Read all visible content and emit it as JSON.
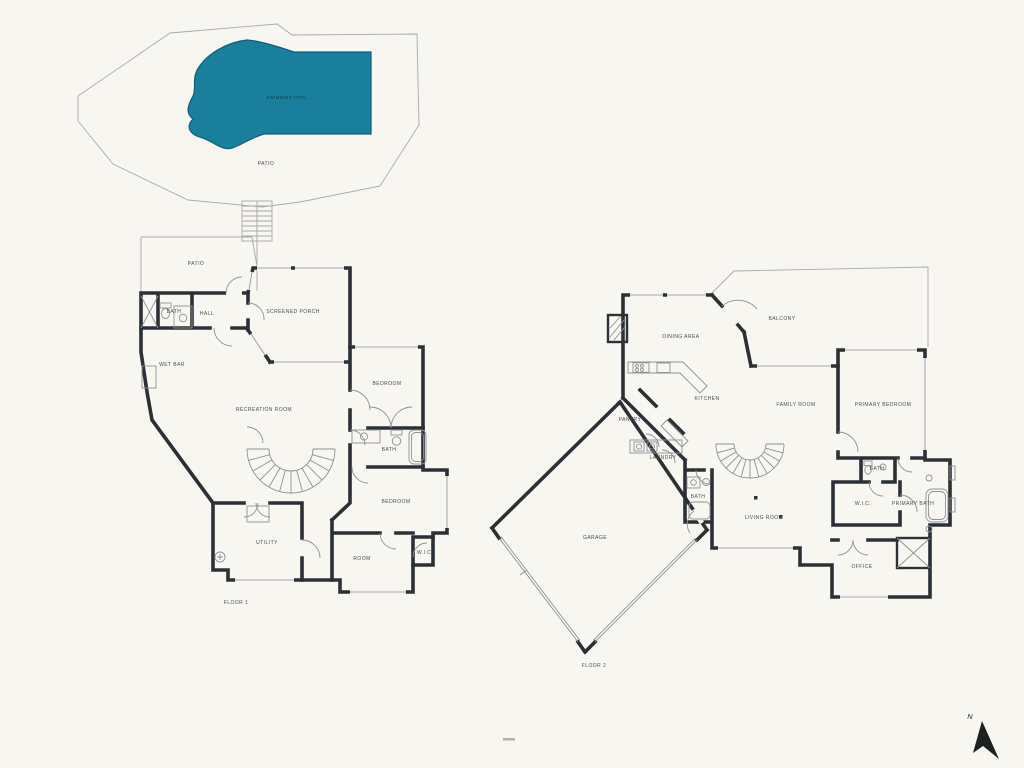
{
  "colors": {
    "background": "#f7f6f0",
    "walls": "#2b3036",
    "thin_line": "#a7abad",
    "window_line": "#8d9296",
    "fixture_line": "#8d9296",
    "label": "#4a4f53",
    "pool": "#1a7f9d",
    "pool_outline": "#0f5f78",
    "pool_text": "#0b3a49",
    "compass": "#1d2124"
  },
  "pool_area": {
    "pool_label": "SWIMMING POOL",
    "patio_label": "PATIO"
  },
  "floor1": {
    "title": "FLOOR 1",
    "rooms": {
      "patio": "PATIO",
      "bath": "BATH",
      "hall": "HALL",
      "screened_porch": "SCREENED PORCH",
      "wet_bar": "WET BAR",
      "bedroom_upper": "BEDROOM",
      "recreation_room": "RECREATION ROOM",
      "bath_right": "BATH",
      "bedroom_lower": "BEDROOM",
      "utility": "UTILITY",
      "room": "ROOM",
      "wic": "W.I.C."
    }
  },
  "floor2": {
    "title": "FLOOR 2",
    "rooms": {
      "dining_area": "DINING AREA",
      "balcony": "BALCONY",
      "kitchen": "KITCHEN",
      "family_room": "FAMILY ROOM",
      "primary_bedroom": "PRIMARY BEDROOM",
      "pantry": "PANTRY",
      "laundry": "LAUNDRY",
      "bath": "BATH",
      "living_room": "LIVING ROOM",
      "bath_small": "BATH",
      "wic": "W.I.C.",
      "primary_bath": "PRIMARY BATH",
      "garage": "GARAGE",
      "office": "OFFICE"
    }
  },
  "compass": {
    "north_label": "N"
  }
}
